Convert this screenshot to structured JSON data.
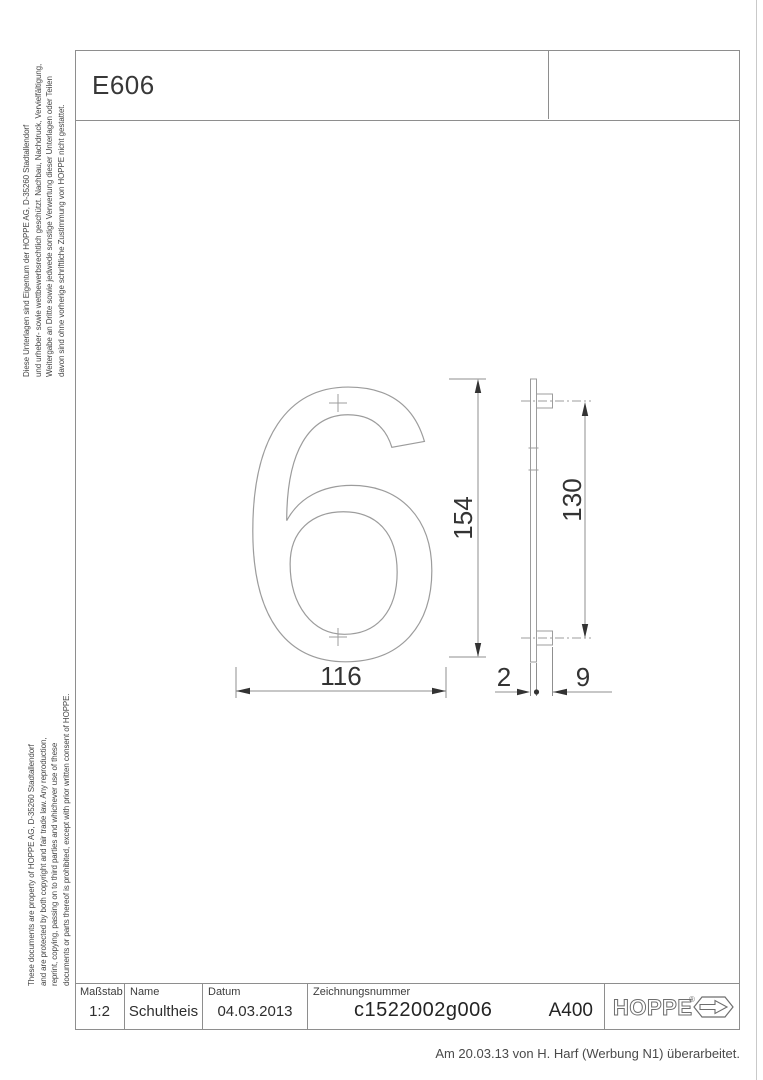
{
  "sheet": {
    "doc_code": "E606",
    "revision_note": "Am 20.03.13 von H. Harf (Werbung N1) überarbeitet."
  },
  "legal_de": {
    "lines": [
      "Diese Unterlagen sind Eigentum der  HOPPE AG, D-35260 Stadtallendorf",
      "und urheber- sowie wettbewerbsrechtlich geschützt. Nachbau, Nachdruck, Vervielfältigung,",
      "Weitergabe an Dritte sowie jedwede sonstige Verwertung dieser Unterlagen oder Teilen",
      "davon sind ohne vorherige schriftliche Zustimmung von HOPPE nicht gestattet."
    ]
  },
  "legal_en": {
    "lines": [
      "These documents are property of  HOPPE AG, D-35260 Stadtallendorf",
      "and are protected by both copyright and fair trade law. Any reproduction,",
      "reprint, copying, passing on to third parties and whichever use of these",
      "documents or parts thereof is prohibited, except with prior written consent of HOPPE."
    ]
  },
  "drawing": {
    "numeral": "6",
    "dim_height": "154",
    "dim_width": "116",
    "dim_hole_spacing": "130",
    "dim_thickness": "2",
    "dim_boss_depth": "9"
  },
  "title_block": {
    "scale_label": "Maßstab",
    "scale_value": "1:2",
    "name_label": "Name",
    "name_value": "Schultheis",
    "date_label": "Datum",
    "date_value": "04.03.2013",
    "number_label": "Zeichnungsnummer",
    "number_value": "c1522002g006",
    "format_value": "A400",
    "logo_text": "HOPPE",
    "logo_mark": "®"
  },
  "colors": {
    "frame_line": "#8e8e8e",
    "drawing_line": "#9c9c9c",
    "dimension_ink": "#333333"
  }
}
